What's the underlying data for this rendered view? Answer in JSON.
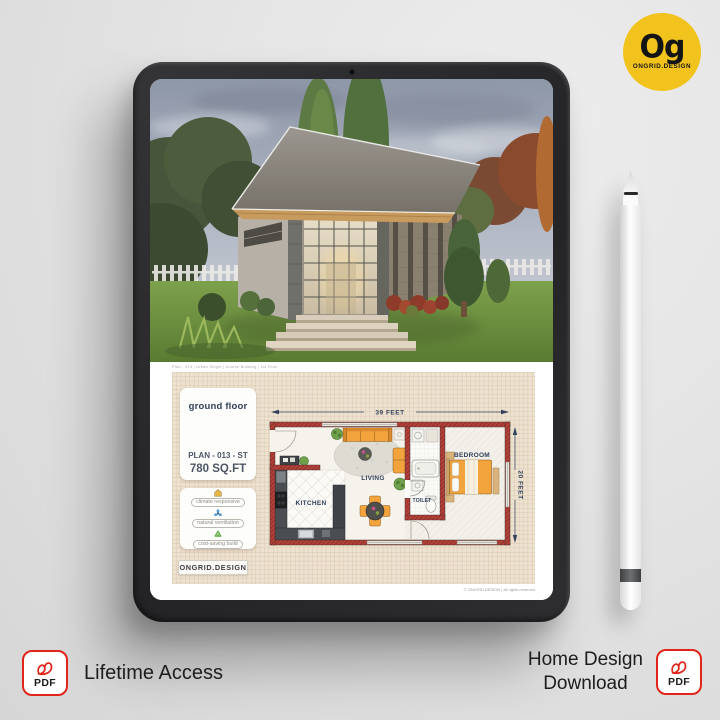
{
  "brand": {
    "monogram": "Og",
    "name": "ONGRID.DESIGN",
    "logo_bg": "#F2C31D"
  },
  "plan": {
    "meta_line": "Plan - 013 | Urban Single | Source Building | 1st Floor",
    "ground_floor_label": "ground floor",
    "plan_code": "PLAN - 013 - ST",
    "area": "780 SQ.FT",
    "features": [
      {
        "icon": "climate-house-icon",
        "label": "climate responsive"
      },
      {
        "icon": "ventilation-fan-icon",
        "label": "natural ventilation"
      },
      {
        "icon": "recycle-icon",
        "label": "cost-saving build"
      }
    ],
    "brand_box": "ONGRID.DESIGN",
    "copyright": "© ONGRID.DESIGN | all rights reserved",
    "dim_width": "39 FEET",
    "dim_height": "20 FEET",
    "rooms": {
      "kitchen": "KITCHEN",
      "living": "LIVING",
      "toilet": "TOILET",
      "bedroom": "BEDROOM"
    }
  },
  "footer": {
    "left_label": "Lifetime Access",
    "right_line1": "Home Design",
    "right_line2": "Download",
    "pdf_badge": "PDF"
  },
  "colors": {
    "accent_yellow": "#F2C31D",
    "pdf_red": "#E1251B",
    "wall_red": "#B2413A",
    "plan_navy": "#2E3D59",
    "furniture_orange": "#F2A33C",
    "paper": "#EDE1D0"
  }
}
